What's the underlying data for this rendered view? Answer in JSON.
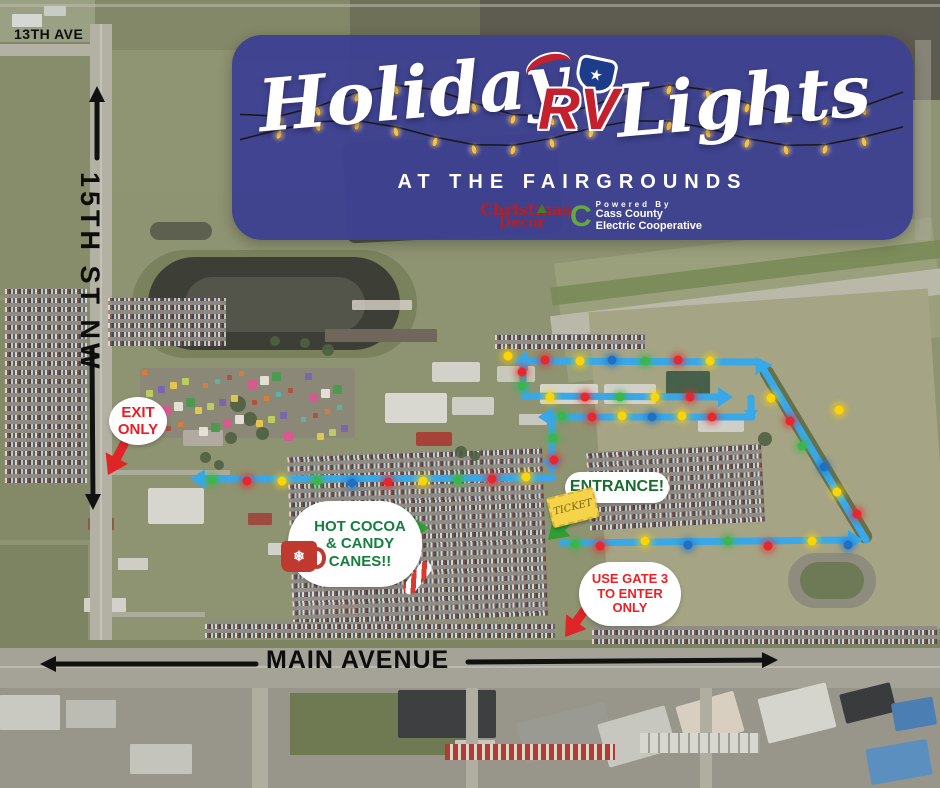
{
  "banner": {
    "title_left": "Holiday",
    "title_right": "Lights",
    "rv_logo_text": "RV",
    "subtitle": "AT THE FAIRGROUNDS",
    "christmas_decor_line1": "Christmas",
    "christmas_decor_line2": "Decor",
    "powered_by": "Powered By",
    "coop_name_line1": "Cass County",
    "coop_name_line2": "Electric Cooperative"
  },
  "streets": {
    "ave_13": "13TH AVE",
    "st_15": "15TH ST NW",
    "main_avenue": "MAIN AVENUE"
  },
  "callouts": {
    "exit": {
      "line1": "EXIT",
      "line2": "ONLY"
    },
    "cocoa": {
      "line1": "HOT COCOA",
      "line2": "& CANDY",
      "line3": "CANES!!"
    },
    "entrance": {
      "label": "ENTRANCE!",
      "ticket_label": "TICKET"
    },
    "gate3": {
      "line1": "USE GATE 3",
      "line2": "TO ENTER",
      "line3": "ONLY"
    }
  },
  "colors": {
    "banner_bg": "#3e4191",
    "route_blue": "#38a8e8",
    "dot_red": "#e8262b",
    "dot_yellow": "#ffd400",
    "dot_green": "#3cb54a",
    "dot_blue": "#1f6fc4",
    "callout_red": "#e02428",
    "callout_green": "#2e9e35",
    "street_black": "#111111"
  },
  "map": {
    "route_segments": [
      {
        "name": "route-bottom-eastbound",
        "pts": [
          [
            562,
            543
          ],
          [
            848,
            540
          ]
        ],
        "arrow": true
      },
      {
        "name": "route-diagonal-northbound",
        "pts": [
          [
            866,
            540
          ],
          [
            764,
            370
          ]
        ],
        "arrow": true
      },
      {
        "name": "route-top-westbound",
        "pts": [
          [
            757,
            362
          ],
          [
            528,
            361
          ]
        ],
        "arrow": true
      },
      {
        "name": "route-drop-1",
        "pts": [
          [
            523,
            364
          ],
          [
            523,
            386
          ]
        ],
        "arrow": true,
        "small": true
      },
      {
        "name": "route-row2-eastbound",
        "pts": [
          [
            524,
            396
          ],
          [
            718,
            397
          ]
        ],
        "arrow": true
      },
      {
        "name": "route-connector-down",
        "pts": [
          [
            751,
            398
          ],
          [
            751,
            410
          ]
        ],
        "arrow": true,
        "small": true
      },
      {
        "name": "route-row3-westbound",
        "pts": [
          [
            752,
            417
          ],
          [
            553,
            417
          ]
        ],
        "arrow": true
      },
      {
        "name": "route-drop-2",
        "pts": [
          [
            552,
            421
          ],
          [
            552,
            460
          ]
        ],
        "arrow": true
      },
      {
        "name": "route-exit-westbound",
        "pts": [
          [
            552,
            478
          ],
          [
            205,
            479
          ]
        ],
        "arrow": true
      }
    ],
    "route_dots": [
      [
        508,
        356,
        "y"
      ],
      [
        545,
        360,
        "r"
      ],
      [
        580,
        361,
        "y"
      ],
      [
        612,
        360,
        "b"
      ],
      [
        645,
        361,
        "g"
      ],
      [
        678,
        360,
        "r"
      ],
      [
        710,
        361,
        "y"
      ],
      [
        522,
        372,
        "r"
      ],
      [
        522,
        386,
        "g"
      ],
      [
        550,
        397,
        "y"
      ],
      [
        585,
        397,
        "r"
      ],
      [
        620,
        397,
        "g"
      ],
      [
        655,
        397,
        "y"
      ],
      [
        690,
        397,
        "r"
      ],
      [
        839,
        410,
        "y"
      ],
      [
        562,
        416,
        "g"
      ],
      [
        592,
        417,
        "r"
      ],
      [
        622,
        416,
        "y"
      ],
      [
        652,
        417,
        "b"
      ],
      [
        682,
        416,
        "y"
      ],
      [
        712,
        417,
        "r"
      ],
      [
        553,
        438,
        "g"
      ],
      [
        554,
        460,
        "r"
      ],
      [
        212,
        480,
        "g"
      ],
      [
        247,
        481,
        "r"
      ],
      [
        282,
        481,
        "y"
      ],
      [
        317,
        481,
        "g"
      ],
      [
        352,
        483,
        "b"
      ],
      [
        388,
        482,
        "r"
      ],
      [
        423,
        481,
        "y"
      ],
      [
        458,
        480,
        "g"
      ],
      [
        492,
        479,
        "r"
      ],
      [
        526,
        477,
        "y"
      ],
      [
        575,
        544,
        "g"
      ],
      [
        600,
        546,
        "r"
      ],
      [
        645,
        541,
        "y"
      ],
      [
        688,
        545,
        "b"
      ],
      [
        728,
        541,
        "g"
      ],
      [
        768,
        546,
        "r"
      ],
      [
        812,
        541,
        "y"
      ],
      [
        848,
        545,
        "b"
      ],
      [
        771,
        398,
        "y"
      ],
      [
        790,
        421,
        "r"
      ],
      [
        802,
        446,
        "g"
      ],
      [
        824,
        467,
        "b"
      ],
      [
        837,
        492,
        "y"
      ],
      [
        857,
        514,
        "r"
      ]
    ],
    "street_arrows": [
      {
        "name": "st15-north-arrow",
        "from": [
          97,
          158
        ],
        "to": [
          97,
          86
        ]
      },
      {
        "name": "st15-south-arrow",
        "from": [
          92,
          348
        ],
        "to": [
          93,
          510
        ]
      },
      {
        "name": "main-west-arrow",
        "from": [
          256,
          664
        ],
        "to": [
          40,
          664
        ]
      },
      {
        "name": "main-east-arrow",
        "from": [
          468,
          662
        ],
        "to": [
          778,
          660
        ]
      }
    ],
    "callout_arrows": [
      {
        "name": "exit-arrow",
        "color": "red",
        "from": [
          124,
          444
        ],
        "to": [
          108,
          475
        ]
      },
      {
        "name": "gate3-arrow",
        "color": "red",
        "from": [
          587,
          607
        ],
        "to": [
          565,
          637
        ]
      },
      {
        "name": "entrance-arrow",
        "color": "green",
        "from": [
          582,
          508
        ],
        "to": [
          548,
          540
        ]
      },
      {
        "name": "cocoa-arrow",
        "color": "green",
        "from": [
          390,
          528
        ],
        "to": [
          429,
          528
        ]
      }
    ]
  }
}
